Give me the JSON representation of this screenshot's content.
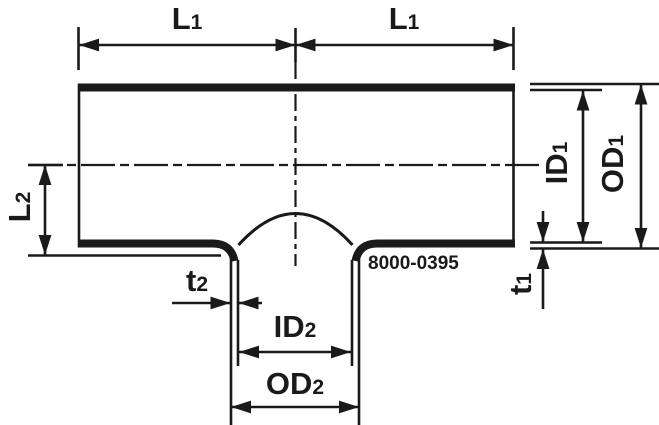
{
  "part_number": "8000-0395",
  "labels": {
    "l1_left": {
      "main": "L",
      "sub": "1"
    },
    "l1_right": {
      "main": "L",
      "sub": "1"
    },
    "l2": {
      "main": "L",
      "sub": "2"
    },
    "id1": {
      "main": "ID",
      "sub": "1"
    },
    "od1": {
      "main": "OD",
      "sub": "1"
    },
    "t1": {
      "main": "t",
      "sub": "1"
    },
    "t2": {
      "main": "t",
      "sub": "2"
    },
    "id2": {
      "main": "ID",
      "sub": "2"
    },
    "od2": {
      "main": "OD",
      "sub": "2"
    }
  },
  "colors": {
    "line": "#1a1a1a",
    "background": "#ffffff"
  }
}
